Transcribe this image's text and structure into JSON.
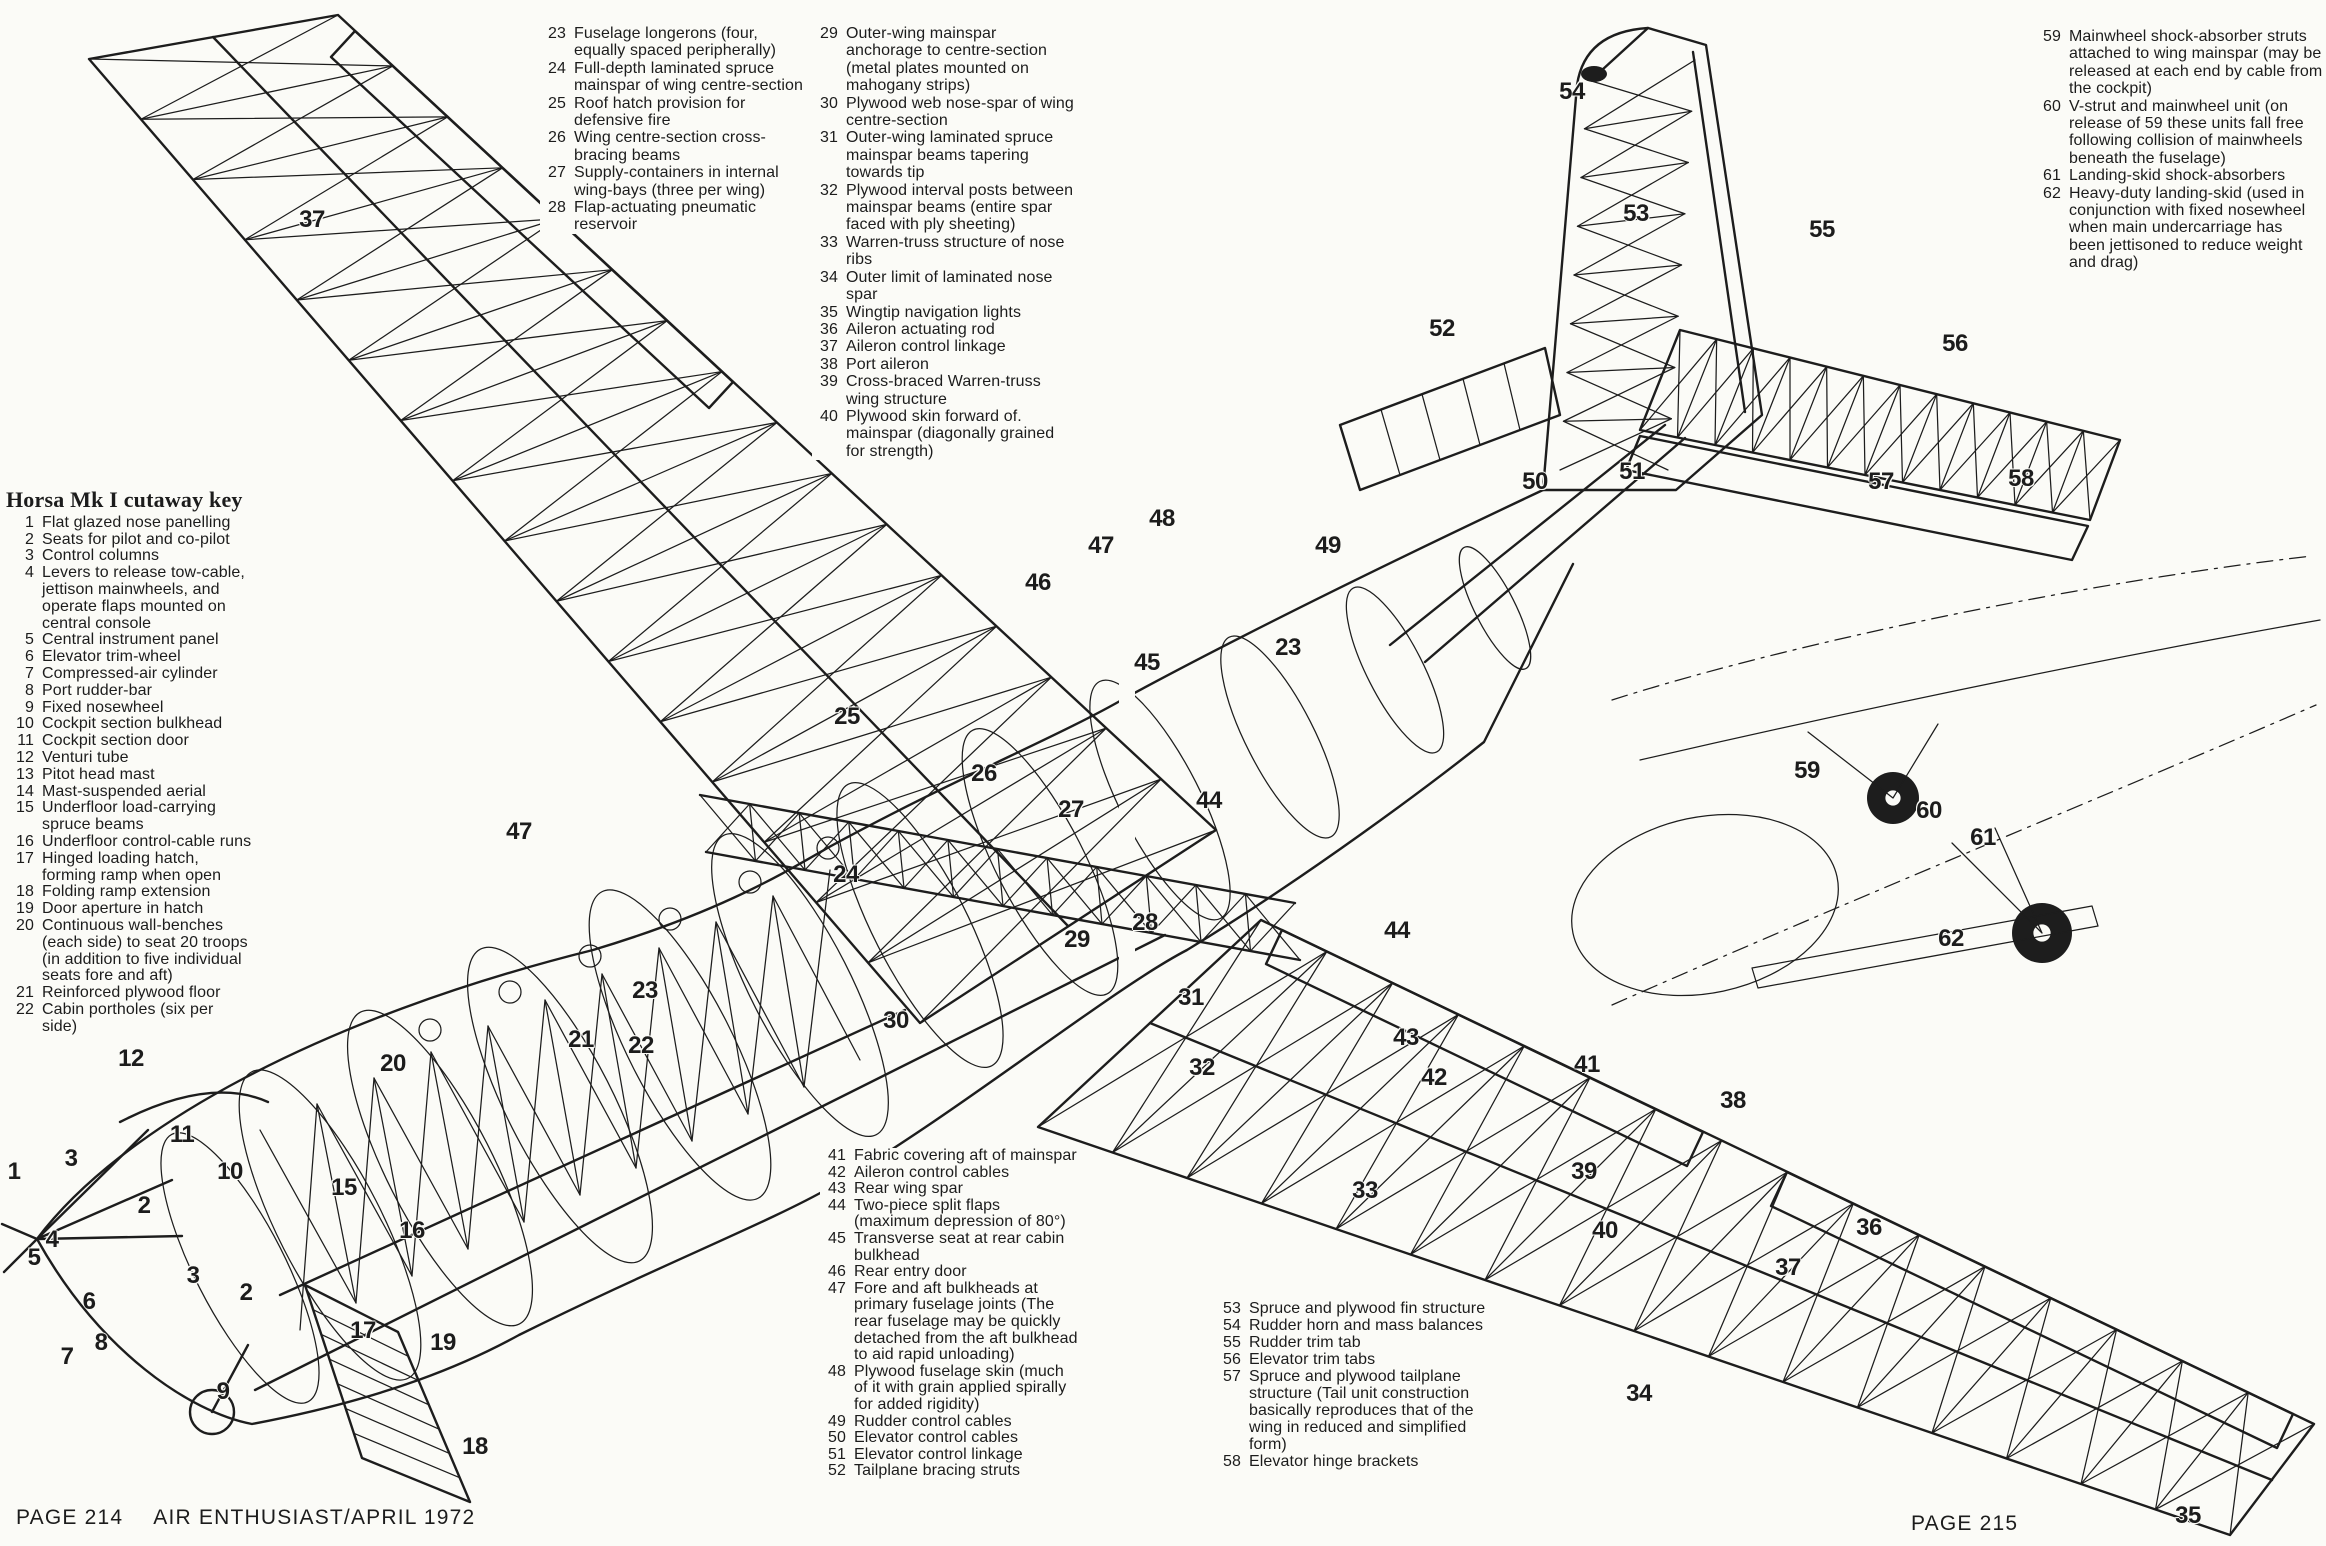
{
  "page": {
    "footer_left_page": "PAGE 214",
    "footer_left_title": "AIR ENTHUSIAST/APRIL 1972",
    "footer_right_page": "PAGE 215",
    "ink_color": "#1d1d1d",
    "paper_color": "#fbfbf7"
  },
  "key": {
    "heading": "Horsa Mk I cutaway key",
    "left_items": [
      {
        "num": "1",
        "text": "Flat glazed nose panelling"
      },
      {
        "num": "2",
        "text": "Seats for pilot and co-pilot"
      },
      {
        "num": "3",
        "text": "Control columns"
      },
      {
        "num": "4",
        "text": "Levers to release tow-cable, jettison mainwheels, and operate flaps mounted on central console"
      },
      {
        "num": "5",
        "text": "Central instrument panel"
      },
      {
        "num": "6",
        "text": "Elevator trim-wheel"
      },
      {
        "num": "7",
        "text": "Compressed-air cylinder"
      },
      {
        "num": "8",
        "text": "Port rudder-bar"
      },
      {
        "num": "9",
        "text": "Fixed nosewheel"
      },
      {
        "num": "10",
        "text": "Cockpit section bulkhead"
      },
      {
        "num": "11",
        "text": "Cockpit section door"
      },
      {
        "num": "12",
        "text": "Venturi tube"
      },
      {
        "num": "13",
        "text": "Pitot head mast"
      },
      {
        "num": "14",
        "text": "Mast-suspended aerial"
      },
      {
        "num": "15",
        "text": "Underfloor load-carrying spruce beams"
      },
      {
        "num": "16",
        "text": "Underfloor control-cable runs"
      },
      {
        "num": "17",
        "text": "Hinged loading hatch, forming ramp when open"
      },
      {
        "num": "18",
        "text": "Folding ramp extension"
      },
      {
        "num": "19",
        "text": "Door aperture in hatch"
      },
      {
        "num": "20",
        "text": "Continuous wall-benches (each side) to seat 20 troops (in addition to five individual seats fore and aft)"
      },
      {
        "num": "21",
        "text": "Reinforced plywood floor"
      },
      {
        "num": "22",
        "text": "Cabin portholes (six per side)"
      }
    ],
    "top_a_items": [
      {
        "num": "23",
        "text": "Fuselage longerons (four, equally spaced peripherally)"
      },
      {
        "num": "24",
        "text": "Full-depth laminated spruce mainspar of wing centre-section"
      },
      {
        "num": "25",
        "text": "Roof hatch provision for defensive fire"
      },
      {
        "num": "26",
        "text": "Wing centre-section cross-bracing beams"
      },
      {
        "num": "27",
        "text": "Supply-containers in internal wing-bays (three per wing)"
      },
      {
        "num": "28",
        "text": "Flap-actuating pneumatic reservoir"
      }
    ],
    "top_b_items": [
      {
        "num": "29",
        "text": "Outer-wing mainspar anchorage to centre-section (metal plates mounted on mahogany strips)"
      },
      {
        "num": "30",
        "text": "Plywood web nose-spar of wing centre-section"
      },
      {
        "num": "31",
        "text": "Outer-wing laminated spruce mainspar beams tapering towards tip"
      },
      {
        "num": "32",
        "text": "Plywood interval posts between mainspar beams (entire spar faced with ply sheeting)"
      },
      {
        "num": "33",
        "text": "Warren-truss structure of nose ribs"
      },
      {
        "num": "34",
        "text": "Outer limit of laminated nose spar"
      },
      {
        "num": "35",
        "text": "Wingtip navigation lights"
      },
      {
        "num": "36",
        "text": "Aileron actuating rod"
      },
      {
        "num": "37",
        "text": "Aileron control linkage"
      },
      {
        "num": "38",
        "text": "Port aileron"
      },
      {
        "num": "39",
        "text": "Cross-braced Warren-truss wing structure"
      },
      {
        "num": "40",
        "text": "Plywood skin forward of. mainspar (diagonally grained for strength)"
      }
    ],
    "top_right_items": [
      {
        "num": "59",
        "text": "Mainwheel shock-absorber struts attached to wing mainspar (may be released at each end by cable from the cockpit)"
      },
      {
        "num": "60",
        "text": "V-strut and mainwheel unit (on release of 59 these units fall free following collision of mainwheels beneath the fuselage)"
      },
      {
        "num": "61",
        "text": "Landing-skid shock-absorbers"
      },
      {
        "num": "62",
        "text": "Heavy-duty landing-skid (used in conjunction with fixed nosewheel when main undercarriage has been jettisoned to reduce weight and drag)"
      }
    ],
    "bottom_a_items": [
      {
        "num": "41",
        "text": "Fabric covering aft of mainspar"
      },
      {
        "num": "42",
        "text": "Aileron control cables"
      },
      {
        "num": "43",
        "text": "Rear wing spar"
      },
      {
        "num": "44",
        "text": "Two-piece split flaps (maximum depression of 80°)"
      },
      {
        "num": "45",
        "text": "Transverse seat at rear cabin bulkhead"
      },
      {
        "num": "46",
        "text": "Rear entry door"
      },
      {
        "num": "47",
        "text": "Fore and aft bulkheads at primary fuselage joints (The rear fuselage may be quickly detached from the aft bulkhead to aid rapid unloading)"
      },
      {
        "num": "48",
        "text": "Plywood fuselage skin (much of it with grain applied spirally for added rigidity)"
      },
      {
        "num": "49",
        "text": "Rudder control cables"
      },
      {
        "num": "50",
        "text": "Elevator control cables"
      },
      {
        "num": "51",
        "text": "Elevator control linkage"
      },
      {
        "num": "52",
        "text": "Tailplane bracing struts"
      }
    ],
    "bottom_b_items": [
      {
        "num": "53",
        "text": "Spruce and plywood fin structure"
      },
      {
        "num": "54",
        "text": "Rudder horn and mass balances"
      },
      {
        "num": "55",
        "text": "Rudder trim tab"
      },
      {
        "num": "56",
        "text": "Elevator trim tabs"
      },
      {
        "num": "57",
        "text": "Spruce and plywood tailplane structure (Tail unit construction basically reproduces that of the wing in reduced and simplified form)"
      },
      {
        "num": "58",
        "text": "Elevator hinge brackets"
      }
    ]
  },
  "drawing": {
    "subject": "Airspeed Horsa Mk I glider cutaway",
    "callouts": [
      {
        "n": "37",
        "x": 312,
        "y": 220
      },
      {
        "n": "54",
        "x": 1572,
        "y": 92
      },
      {
        "n": "53",
        "x": 1636,
        "y": 214
      },
      {
        "n": "55",
        "x": 1822,
        "y": 230
      },
      {
        "n": "52",
        "x": 1442,
        "y": 329
      },
      {
        "n": "56",
        "x": 1955,
        "y": 344
      },
      {
        "n": "50",
        "x": 1535,
        "y": 482
      },
      {
        "n": "51",
        "x": 1632,
        "y": 472
      },
      {
        "n": "57",
        "x": 1881,
        "y": 482
      },
      {
        "n": "58",
        "x": 2021,
        "y": 479
      },
      {
        "n": "49",
        "x": 1328,
        "y": 546
      },
      {
        "n": "48",
        "x": 1162,
        "y": 519
      },
      {
        "n": "47",
        "x": 1101,
        "y": 546
      },
      {
        "n": "46",
        "x": 1038,
        "y": 583
      },
      {
        "n": "45",
        "x": 1147,
        "y": 663
      },
      {
        "n": "23",
        "x": 1288,
        "y": 648
      },
      {
        "n": "25",
        "x": 847,
        "y": 717
      },
      {
        "n": "26",
        "x": 984,
        "y": 774
      },
      {
        "n": "27",
        "x": 1071,
        "y": 810
      },
      {
        "n": "44",
        "x": 1209,
        "y": 801
      },
      {
        "n": "24",
        "x": 846,
        "y": 875
      },
      {
        "n": "59",
        "x": 1807,
        "y": 771
      },
      {
        "n": "60",
        "x": 1929,
        "y": 811
      },
      {
        "n": "61",
        "x": 1983,
        "y": 838
      },
      {
        "n": "62",
        "x": 1951,
        "y": 939
      },
      {
        "n": "29",
        "x": 1077,
        "y": 940
      },
      {
        "n": "28",
        "x": 1145,
        "y": 923
      },
      {
        "n": "30",
        "x": 896,
        "y": 1021
      },
      {
        "n": "31",
        "x": 1191,
        "y": 998
      },
      {
        "n": "43",
        "x": 1406,
        "y": 1038
      },
      {
        "n": "42",
        "x": 1434,
        "y": 1078
      },
      {
        "n": "32",
        "x": 1202,
        "y": 1068
      },
      {
        "n": "41",
        "x": 1587,
        "y": 1065
      },
      {
        "n": "38",
        "x": 1733,
        "y": 1101
      },
      {
        "n": "44",
        "x": 1397,
        "y": 931
      },
      {
        "n": "47",
        "x": 519,
        "y": 832
      },
      {
        "n": "23",
        "x": 645,
        "y": 991
      },
      {
        "n": "21",
        "x": 581,
        "y": 1040
      },
      {
        "n": "22",
        "x": 641,
        "y": 1046
      },
      {
        "n": "20",
        "x": 393,
        "y": 1064
      },
      {
        "n": "13",
        "x": 174,
        "y": 1024
      },
      {
        "n": "14",
        "x": 208,
        "y": 1012
      },
      {
        "n": "12",
        "x": 131,
        "y": 1059
      },
      {
        "n": "11",
        "x": 182,
        "y": 1135
      },
      {
        "n": "10",
        "x": 230,
        "y": 1172
      },
      {
        "n": "15",
        "x": 344,
        "y": 1188
      },
      {
        "n": "16",
        "x": 412,
        "y": 1231
      },
      {
        "n": "1",
        "x": 14,
        "y": 1172
      },
      {
        "n": "3",
        "x": 71,
        "y": 1159
      },
      {
        "n": "2",
        "x": 144,
        "y": 1206
      },
      {
        "n": "4",
        "x": 52,
        "y": 1240
      },
      {
        "n": "5",
        "x": 34,
        "y": 1258
      },
      {
        "n": "6",
        "x": 89,
        "y": 1302
      },
      {
        "n": "3",
        "x": 193,
        "y": 1276
      },
      {
        "n": "2",
        "x": 246,
        "y": 1293
      },
      {
        "n": "7",
        "x": 67,
        "y": 1357
      },
      {
        "n": "8",
        "x": 101,
        "y": 1343
      },
      {
        "n": "9",
        "x": 223,
        "y": 1392
      },
      {
        "n": "17",
        "x": 363,
        "y": 1331
      },
      {
        "n": "19",
        "x": 443,
        "y": 1343
      },
      {
        "n": "18",
        "x": 475,
        "y": 1447
      },
      {
        "n": "39",
        "x": 1584,
        "y": 1172
      },
      {
        "n": "40",
        "x": 1605,
        "y": 1231
      },
      {
        "n": "33",
        "x": 1365,
        "y": 1191
      },
      {
        "n": "36",
        "x": 1869,
        "y": 1228
      },
      {
        "n": "37",
        "x": 1788,
        "y": 1268
      },
      {
        "n": "34",
        "x": 1639,
        "y": 1394
      },
      {
        "n": "35",
        "x": 2188,
        "y": 1516
      }
    ]
  }
}
